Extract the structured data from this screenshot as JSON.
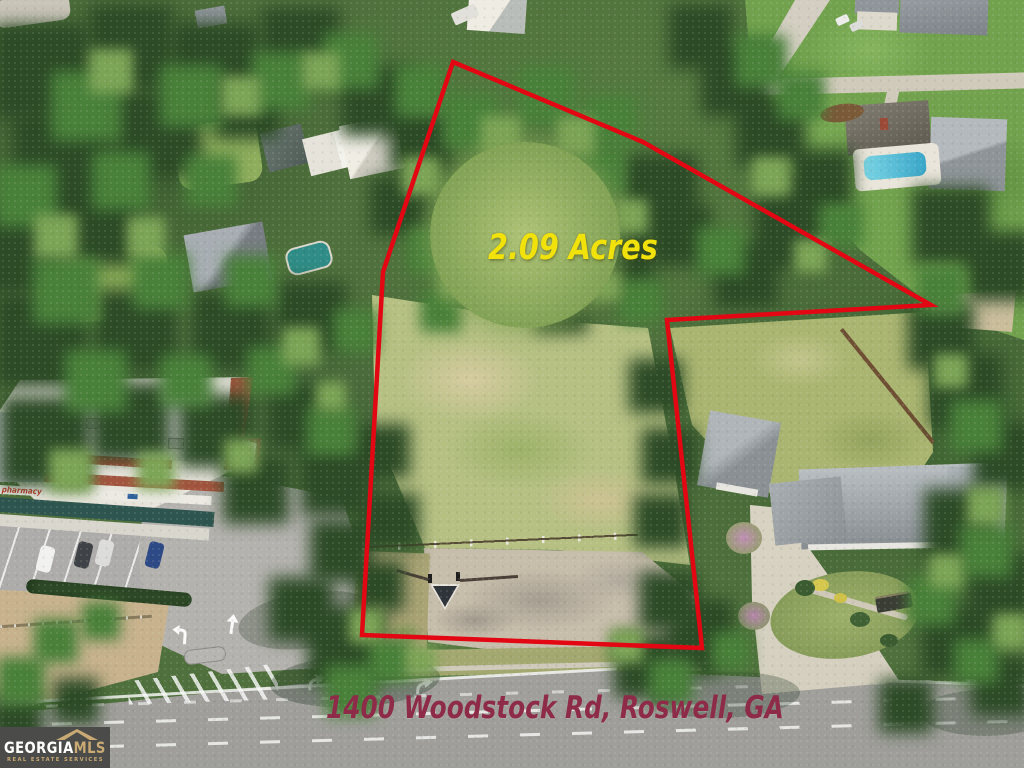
{
  "title": "Aerial property listing photo",
  "overlays": {
    "acres_label": "2.09 Acres",
    "address_label": "1400 Woodstock Rd, Roswell, GA"
  },
  "boundary": {
    "points_px": "453,62 643,142 931,305 667,320 702,648 362,635 383,272",
    "color": "#e30613",
    "stroke_width": "4.5"
  },
  "logo": {
    "brand_part1": "GEORGIA",
    "brand_part2": "MLS",
    "tagline": "REAL ESTATE SERVICES"
  },
  "building_signs": {
    "pharmacy": "pharmacy"
  },
  "colors": {
    "boundary_red": "#e30613",
    "acres_yellow": "#f2e20c",
    "address_maroon": "#8d2b49",
    "logo_bg": "#4b4b49",
    "logo_gold": "#c9aa74",
    "logo_white": "#ffffff",
    "forest_green": "#2d4b27",
    "meadow_green": "#b6c083",
    "road_gray": "#a7a6a2"
  }
}
